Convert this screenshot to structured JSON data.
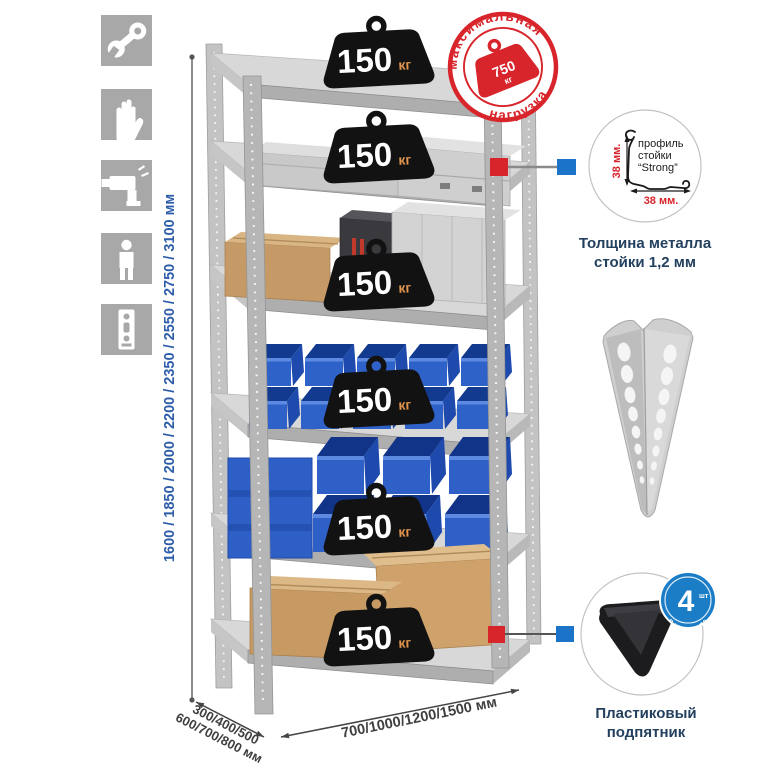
{
  "side_icons": {
    "items": [
      {
        "icon": "wrench-icon"
      },
      {
        "icon": "gloves-icon"
      },
      {
        "icon": "drill-icon"
      },
      {
        "icon": "person-icon"
      },
      {
        "icon": "rack-post-icon"
      }
    ]
  },
  "height_dimension": {
    "label": "1600 / 1850 / 2000 / 2200 / 2350 / 2550 / 2750 / 3100 мм"
  },
  "shelf_badges": [
    {
      "value": "150",
      "unit": "кг"
    },
    {
      "value": "150",
      "unit": "кг"
    },
    {
      "value": "150",
      "unit": "кг"
    },
    {
      "value": "150",
      "unit": "кг"
    },
    {
      "value": "150",
      "unit": "кг"
    },
    {
      "value": "150",
      "unit": "кг"
    }
  ],
  "max_load_stamp": {
    "arc_top": "максимальная",
    "arc_bottom": "нагрузка",
    "value": "750",
    "unit": "кг"
  },
  "profile_callout": {
    "label_line1": "профиль",
    "label_line2": "стойки",
    "label_line3": "“Strong”",
    "dim_vertical": "38 мм.",
    "dim_horizontal": "38 мм.",
    "caption_line1": "Толщина металла",
    "caption_line2": "стойки 1,2 мм"
  },
  "foot_callout": {
    "badge_number": "4",
    "badge_unit": "шт",
    "badge_arc": "в комплекте",
    "caption_line1": "Пластиковый",
    "caption_line2": "подпятник"
  },
  "depth_dimension": {
    "line1": "300/400/500",
    "line2": "600/700/800 мм"
  },
  "width_dimension": {
    "label": "700/1000/1200/1500 мм"
  },
  "colors": {
    "accent_red": "#d8252b",
    "accent_blue": "#1b74c8",
    "dim_blue": "#2d5da9",
    "caption_navy": "#23405f",
    "bin_blue": "#2e60c8"
  }
}
